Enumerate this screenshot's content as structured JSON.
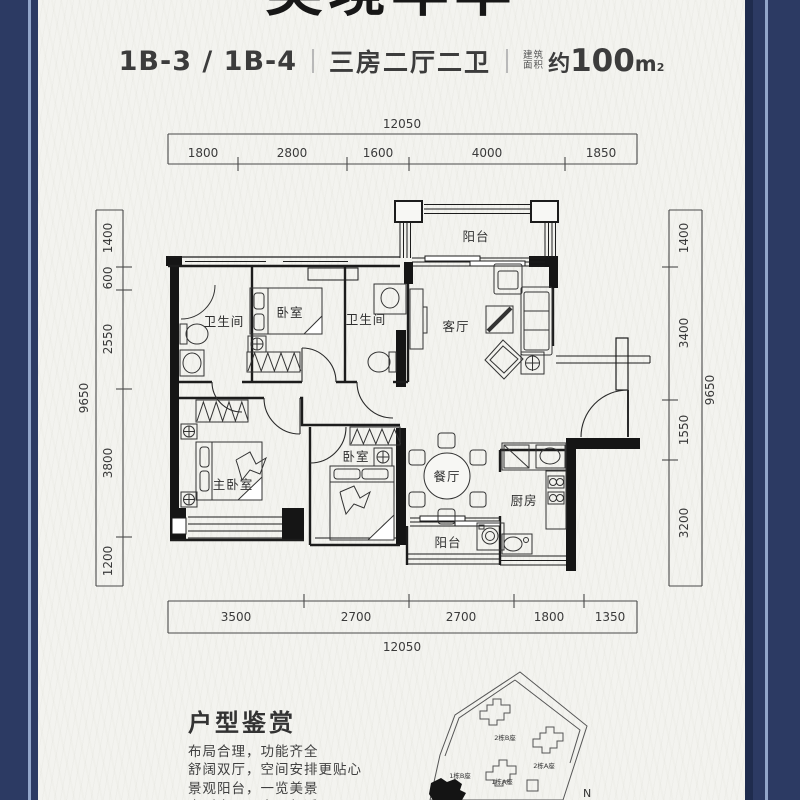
{
  "frame": {
    "navy": "#2c3a63",
    "accent": "#92a5c9"
  },
  "header": {
    "main_title": "美境年华",
    "unit_code": "1B-3 / 1B-4",
    "layout_desc": "三房二厅二卫",
    "area_label_top": "建筑",
    "area_label_bottom": "面积",
    "area_approx": "约",
    "area_number": "100",
    "area_unit": "m",
    "area_sup": "2"
  },
  "dims": {
    "top": {
      "overall": "12050",
      "s1": "1800",
      "s2": "2800",
      "s3": "1600",
      "s4": "4000",
      "s5": "1850"
    },
    "bottom": {
      "overall": "12050",
      "s1": "3500",
      "s2": "2700",
      "s3": "2700",
      "s4": "1800",
      "s5": "1350"
    },
    "left": {
      "overall": "9650",
      "s1": "1400",
      "s2": "600",
      "s3": "2550",
      "s4": "3800",
      "s5": "1200"
    },
    "right": {
      "overall": "9650",
      "s1": "1400",
      "s2": "3400",
      "s3": "1550",
      "s4": "3200"
    }
  },
  "rooms": {
    "bath1": "卫生间",
    "bedroom_top": "卧室",
    "bath2": "卫生间",
    "living": "客厅",
    "balcony_top": "阳台",
    "master": "主卧室",
    "bedroom_mid": "卧室",
    "dining": "餐厅",
    "kitchen": "厨房",
    "balcony_bottom": "阳台"
  },
  "appreciation": {
    "heading": "户型鉴赏",
    "line1": "布局合理，功能齐全",
    "line2": "舒阔双厅，空间安排更贴心",
    "line3": "景观阳台，一览美景",
    "line4": "户型方正，实用舒适"
  },
  "sitemap": {
    "b2b": "2栋B座",
    "b2a": "2栋A座",
    "b1b": "1栋B座",
    "b1a": "1栋A座",
    "north": "N"
  }
}
